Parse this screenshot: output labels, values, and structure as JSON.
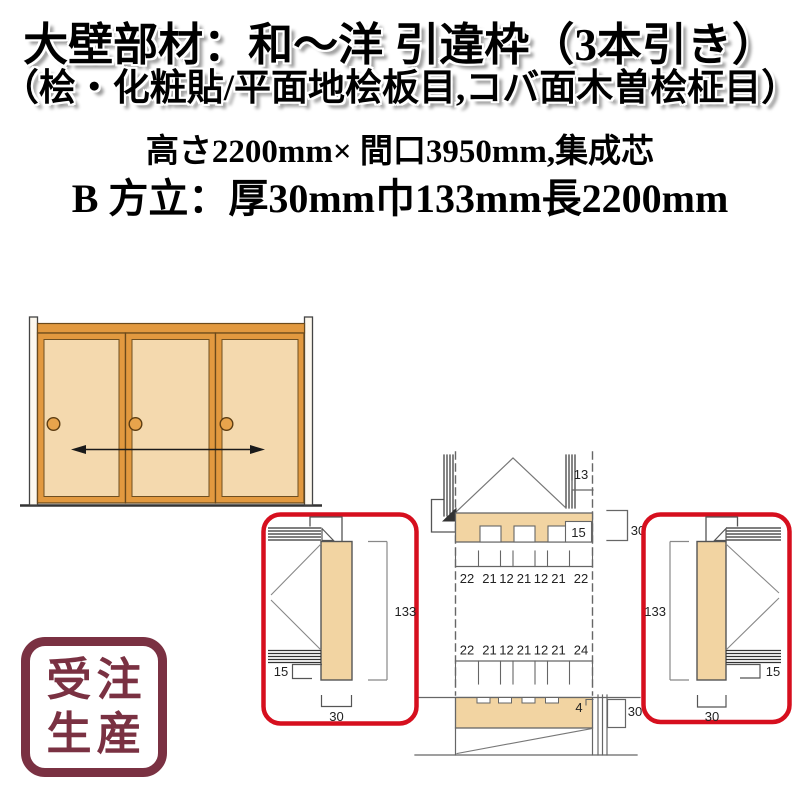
{
  "header": {
    "line1": "大壁部材：和～洋 引違枠（3本引き）",
    "line2": "（桧・化粧貼/平面地桧板目,コバ面木曽桧柾目）",
    "line3": "高さ2200mm× 間口3950mm,集成芯",
    "line4": "B 方立：厚30mm巾133mm長2200mm"
  },
  "stamp": {
    "line1": "受注",
    "line2": "生産"
  },
  "colors": {
    "stamp_maroon": "#7a3142",
    "highlight_red": "#d60f1e",
    "wood_tan": "#f2d4a2",
    "door_frame_orange": "#e2993f",
    "door_panel_tan": "#f4d9ae"
  },
  "drawing": {
    "head": {
      "gap": "13",
      "groove_depth": "15",
      "thickness": "30"
    },
    "dim_row_top": [
      "22",
      "21",
      "12",
      "21",
      "12",
      "21",
      "22"
    ],
    "dim_row_bottom": [
      "22",
      "21",
      "12",
      "21",
      "12",
      "21",
      "24"
    ],
    "sill": {
      "step": "4",
      "thickness": "30"
    },
    "left_detail": {
      "height": "133",
      "offset": "15",
      "width": "30"
    },
    "right_detail": {
      "height": "133",
      "offset": "15",
      "width": "30"
    }
  }
}
